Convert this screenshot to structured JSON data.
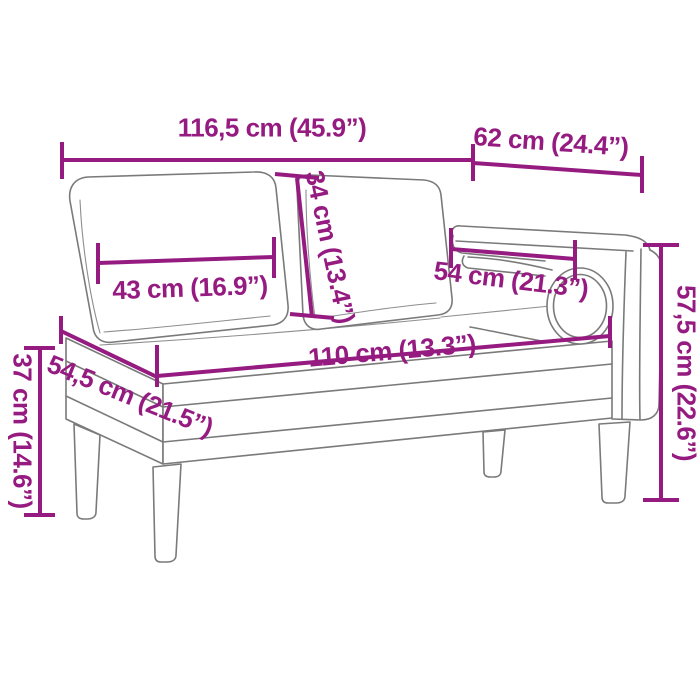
{
  "diagram": {
    "colors": {
      "accent": "#951B81",
      "line": "#7A7A7A",
      "background": "#FFFFFF"
    },
    "dimensions": {
      "overall_width": "116,5 cm (45.9”)",
      "armrest_section_width": "62 cm (24.4”)",
      "back_cushion_width": "43 cm (16.9”)",
      "back_cushion_height": "34 cm (13.4”)",
      "armrest_length": "54 cm (21.3”)",
      "overall_height": "57,5 cm (22.6”)",
      "seat_length": "110 cm (13.3”)",
      "seat_depth": "54,5 cm (21.5”)",
      "seat_height": "37 cm (14.6”)"
    }
  }
}
